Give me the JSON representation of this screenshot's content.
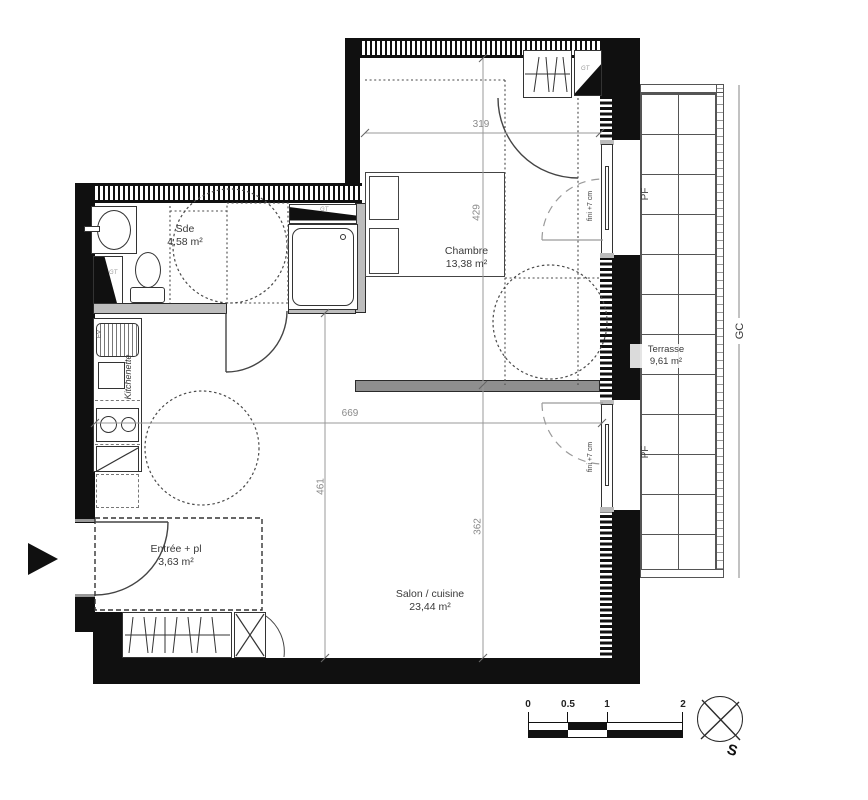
{
  "rooms": {
    "sde": {
      "name": "Sde",
      "area": "4,58 m²"
    },
    "chambre": {
      "name": "Chambre",
      "area": "13,38 m²"
    },
    "terrasse": {
      "name": "Terrasse",
      "area": "9,61 m²"
    },
    "entree": {
      "name": "Entrée + pl",
      "area": "3,63 m²"
    },
    "salon": {
      "name": "Salon / cuisine",
      "area": "23,44 m²"
    }
  },
  "dimensions_cm": {
    "chambre_width": "319",
    "chambre_depth": "429",
    "salon_width": "669",
    "salon_depth_left": "461",
    "salon_depth_right": "362"
  },
  "labels": {
    "kitchenette": "Kitchenette",
    "pf": "PF",
    "gc": "GC",
    "gt": "GT",
    "fini": "fini +7 cm",
    "sink": "EV"
  },
  "scalebar": {
    "t0": "0",
    "t1": "0.5",
    "t2": "1",
    "t3": "2"
  },
  "compass": {
    "south": "S"
  },
  "colors": {
    "wall": "#101010",
    "dim_text": "#8a8a8a",
    "room_text": "#3a3a3a"
  }
}
